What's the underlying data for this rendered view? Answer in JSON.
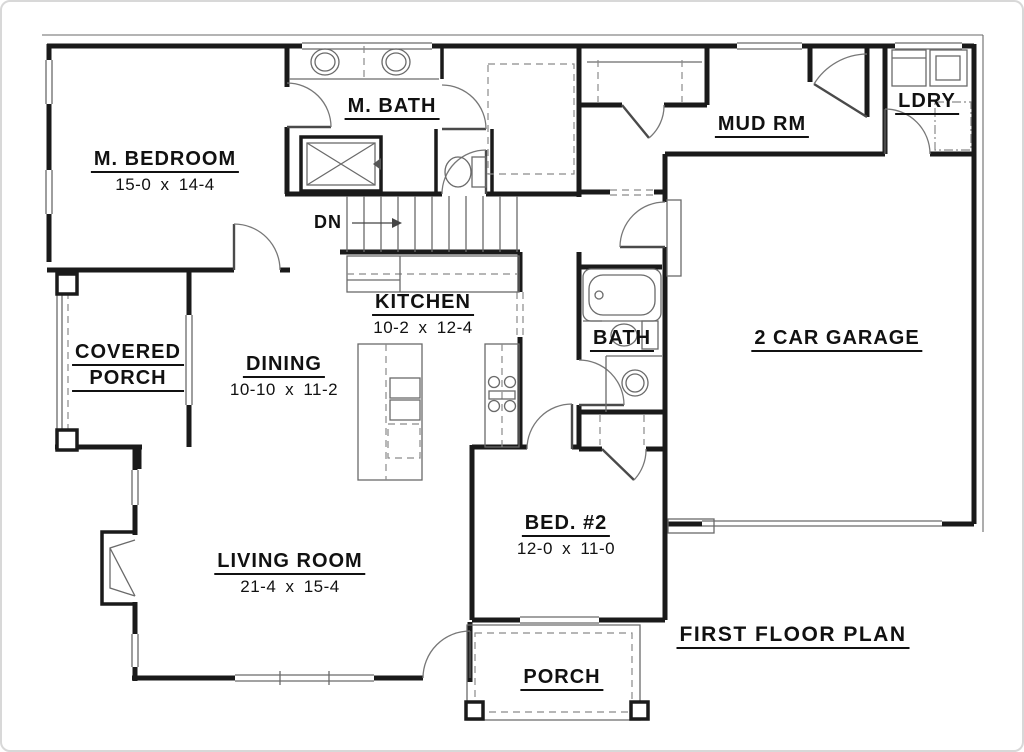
{
  "drawing_title": "FIRST FLOOR PLAN",
  "rooms": [
    {
      "id": "m-bedroom",
      "name": "M. BEDROOM",
      "dims": "15-0 x 14-4"
    },
    {
      "id": "m-bath",
      "name": "M. BATH"
    },
    {
      "id": "mud-rm",
      "name": "MUD RM"
    },
    {
      "id": "ldry",
      "name": "LDRY"
    },
    {
      "id": "kitchen",
      "name": "KITCHEN",
      "dims": "10-2 x 12-4"
    },
    {
      "id": "covered-porch",
      "name_line1": "COVERED",
      "name_line2": "PORCH"
    },
    {
      "id": "dining",
      "name": "DINING",
      "dims": "10-10 x 11-2"
    },
    {
      "id": "bath",
      "name": "BATH"
    },
    {
      "id": "garage",
      "name": "2 CAR GARAGE"
    },
    {
      "id": "living-room",
      "name": "LIVING ROOM",
      "dims": "21-4 x 15-4"
    },
    {
      "id": "bed2",
      "name": "BED. #2",
      "dims": "12-0 x 11-0"
    },
    {
      "id": "porch",
      "name": "PORCH"
    }
  ],
  "annotations": {
    "stair_direction": "DN"
  },
  "colors": {
    "wall": "#1a1a1a",
    "thin_line": "#6a6a6a",
    "dashed_line": "#8a8a8a",
    "door_line": "#4a4a4a",
    "arc_line": "#777777",
    "text": "#111111",
    "background": "#ffffff",
    "frame_border": "#d8d8d8"
  }
}
